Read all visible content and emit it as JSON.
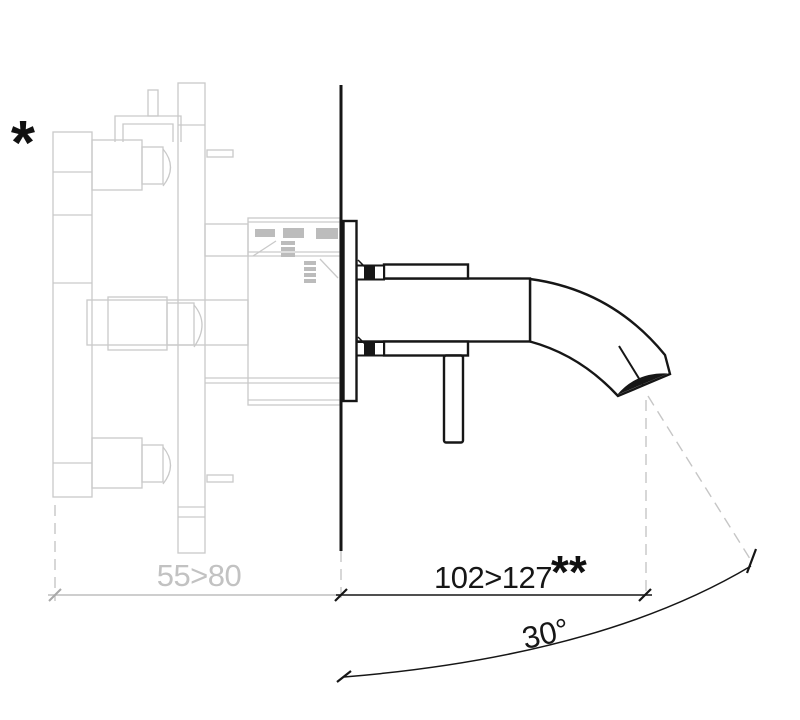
{
  "drawing": {
    "labels": {
      "note_star": "*",
      "note_double_star": "**",
      "dim_wall_depth": "55>80",
      "dim_spout_length": "102>127",
      "dim_angle": "30°"
    },
    "colors": {
      "line_black": "#161616",
      "line_gray": "#c9c9c9",
      "detail_gray_fill": "#bcbcbc",
      "dim_gray_line": "#bdbdbd",
      "dim_gray_text": "#c2c2c2",
      "background": "#ffffff"
    }
  }
}
